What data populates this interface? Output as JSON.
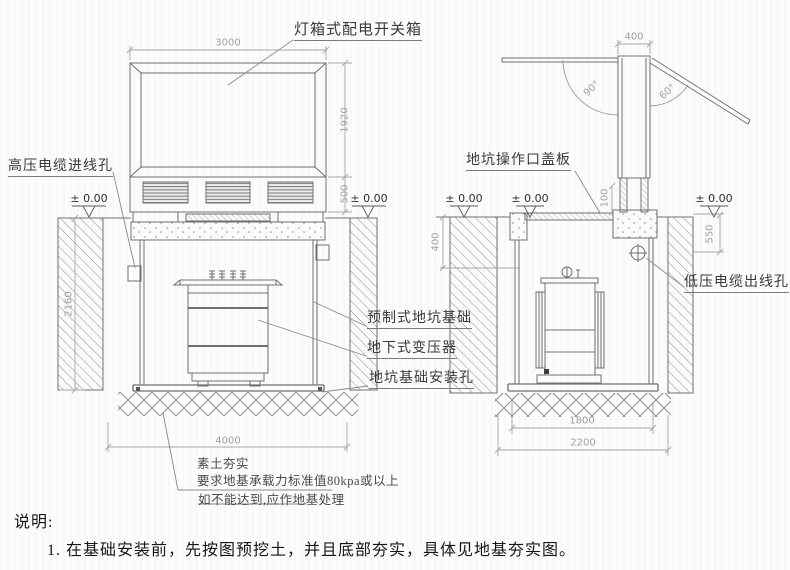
{
  "palette": {
    "object_line": "#6f6f6f",
    "dim_line": "#a6a6a6",
    "dim_text": "#a0a0a0",
    "label_text": "#3a3a3a",
    "note_text": "#161616",
    "background": "#fcfcfc"
  },
  "labels": {
    "switch_box": "灯箱式配电开关箱",
    "hv_cable_hole": "高压电缆进线孔",
    "pit_cover_plate": "地坑操作口盖板",
    "lv_cable_hole": "低压电缆出线孔",
    "precast_pit_foundation": "预制式地坑基础",
    "underground_transformer": "地下式变压器",
    "foundation_mount_hole": "地坑基础安装孔"
  },
  "datum": "± 0.00",
  "dims": {
    "front_width": "3000",
    "front_box_height": "1920",
    "front_louver_height": "500",
    "front_pit_depth": "2160",
    "front_pit_width": "4000",
    "side_top_width": "400",
    "angle_left_door": "90°",
    "angle_right_door": "60°",
    "side_cover_offset": "100",
    "side_pit_top_depth": "400",
    "side_right_depth": "550",
    "side_pit_inner_width": "1800",
    "side_pit_outer_width": "2200"
  },
  "ground_notes": {
    "line1": "素土夯实",
    "line2": "要求地基承载力标准值80kpa或以上",
    "line3": "如不能达到,应作地基处理"
  },
  "notes": {
    "heading": "说明:",
    "item1": "1. 在基础安装前，先按图预挖土，并且底部夯实，具体见地基夯实图。"
  }
}
